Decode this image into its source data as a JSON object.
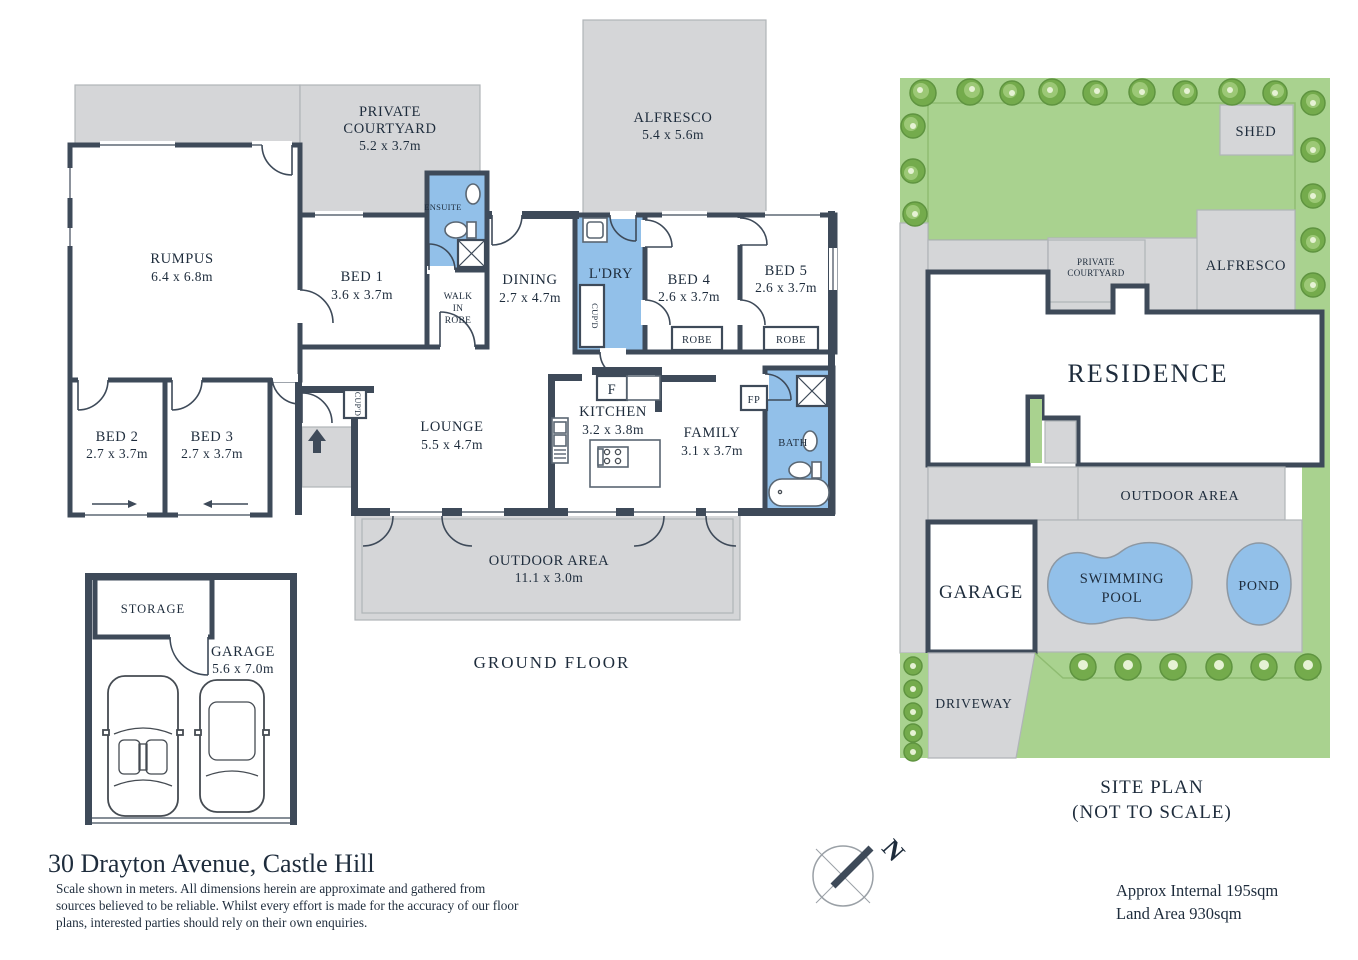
{
  "colors": {
    "wall": "#3e4a59",
    "outdoor_gray": "#d5d6d8",
    "wet_room_blue": "#92c0e9",
    "lawn_green": "#a9d28f",
    "tree_green": "#74ab4c",
    "pool_blue": "#92c0e9",
    "label_text": "#1e2c3c"
  },
  "floor_plan": {
    "title": "GROUND FLOOR",
    "rooms": {
      "private_courtyard": {
        "line1": "PRIVATE",
        "line2": "COURTYARD",
        "dims": "5.2 x 3.7m"
      },
      "alfresco": {
        "name": "ALFRESCO",
        "dims": "5.4 x 5.6m"
      },
      "rumpus": {
        "name": "RUMPUS",
        "dims": "6.4 x 6.8m"
      },
      "bed1": {
        "name": "BED 1",
        "dims": "3.6 x 3.7m"
      },
      "ensuite": {
        "name": "ENSUITE"
      },
      "walk_in_robe": {
        "line1": "WALK",
        "line2": "IN",
        "line3": "ROBE"
      },
      "dining": {
        "name": "DINING",
        "dims": "2.7 x 4.7m"
      },
      "laundry": {
        "name": "L'DRY"
      },
      "bed4": {
        "name": "BED 4",
        "dims": "2.6 x 3.7m"
      },
      "bed5": {
        "name": "BED 5",
        "dims": "2.6 x 3.7m"
      },
      "bed2": {
        "name": "BED 2",
        "dims": "2.7 x 3.7m"
      },
      "bed3": {
        "name": "BED 3",
        "dims": "2.7 x 3.7m"
      },
      "lounge": {
        "name": "LOUNGE",
        "dims": "5.5 x 4.7m"
      },
      "kitchen": {
        "name": "KITCHEN",
        "dims": "3.2 x 3.8m"
      },
      "family": {
        "name": "FAMILY",
        "dims": "3.1 x 3.7m"
      },
      "bath": {
        "name": "BATH"
      },
      "outdoor": {
        "name": "OUTDOOR AREA",
        "dims": "11.1 x 3.0m"
      },
      "storage": {
        "name": "STORAGE"
      },
      "garage": {
        "name": "GARAGE",
        "dims": "5.6 x 7.0m"
      },
      "robe": "ROBE",
      "cupd": "CUP'D",
      "fridge": "F",
      "fireplace": "FP"
    }
  },
  "site_plan": {
    "title_line1": "SITE PLAN",
    "title_line2": "(NOT TO SCALE)",
    "labels": {
      "shed": "SHED",
      "private_courtyard_1": "PRIVATE",
      "private_courtyard_2": "COURTYARD",
      "alfresco": "ALFRESCO",
      "residence": "RESIDENCE",
      "outdoor_area": "OUTDOOR AREA",
      "garage": "GARAGE",
      "swimming_pool_1": "SWIMMING",
      "swimming_pool_2": "POOL",
      "pond": "POND",
      "driveway": "DRIVEWAY"
    }
  },
  "footer": {
    "address": "30 Drayton Avenue, Castle Hill",
    "disclaimer_line1": "Scale shown in meters. All dimensions herein are approximate and gathered from",
    "disclaimer_line2": "sources believed to be  reliable. Whilst every effort is made for the accuracy of our floor",
    "disclaimer_line3": "plans, interested parties should rely on their own enquiries.",
    "approx_internal": "Approx Internal 195sqm",
    "land_area": "Land Area 930sqm",
    "compass_north": "N"
  }
}
